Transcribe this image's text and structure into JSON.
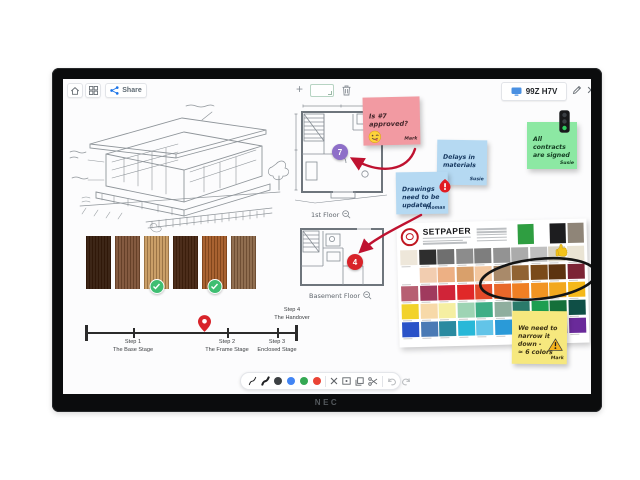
{
  "monitor": {
    "brand_label": "NEC"
  },
  "whiteboard": {
    "top_bar": {
      "share_label": "Share",
      "session_code": "99Z H7V"
    },
    "canvas": {
      "sticky_notes": {
        "approval": {
          "text": "Is #7\napproved?",
          "author": "Mark"
        },
        "delays": {
          "text": "Delays in\nmaterials",
          "author": "Susie"
        },
        "drawings": {
          "text": "Drawings\nneed to be\nupdated",
          "author": "Thomas"
        },
        "contracts": {
          "text": "All\ncontracts\nare signed",
          "author": "Susie"
        },
        "narrow": {
          "text": "We need to\nnarrow it\ndown -\n≈ 6 colors",
          "author": "Mark"
        }
      },
      "floor_plans": {
        "first": {
          "label": "1st Floor",
          "marker": "7",
          "marker_color": "#8e6fc8"
        },
        "basement": {
          "label": "Basement Floor",
          "marker": "4",
          "marker_color": "#d8232a"
        }
      },
      "wood_swatches": {
        "colors": [
          "#331a0b",
          "#7d5136",
          "#c79a60",
          "#42220f",
          "#a45a26",
          "#8a6647"
        ],
        "approved_indexes": [
          2,
          4
        ]
      },
      "palette_card": {
        "brand": "SETPAPER",
        "top_swatches": [
          "#2f9e41",
          "#1d1d1f",
          "#8f8578"
        ],
        "rows": [
          [
            "#eee7da",
            "#2e2e2e",
            "#6f6f6f",
            "#8c8c8c",
            "#7e7e7e",
            "#939393",
            "#ababab",
            "#c0c0c0",
            "#d9d3c3",
            "#eae4d4"
          ],
          [
            "#ffffff",
            "#f2cdb0",
            "#edb084",
            "#d9a06b",
            "#f3c79f",
            "#a98a6a",
            "#916333",
            "#7a4a1a",
            "#5c3310",
            "#7c2436"
          ],
          [
            "#b75f72",
            "#a03a5e",
            "#d02438",
            "#e02828",
            "#e24a2a",
            "#e8682a",
            "#ef7f24",
            "#f29422",
            "#f2a81e",
            "#f5b81a"
          ],
          [
            "#f2d22a",
            "#f7d9a8",
            "#f5efa2",
            "#9ed4b4",
            "#3fae86",
            "#8fae9e",
            "#2a7a6a",
            "#1e9e50",
            "#15703a",
            "#0f4f46"
          ],
          [
            "#2a52c8",
            "#4a7ab5",
            "#2a8aa0",
            "#28b8d8",
            "#62c4e8",
            "#2a9ad8",
            "#1a5aa8",
            "#14327a",
            "#46208a",
            "#6a2a9a"
          ]
        ]
      },
      "timeline": {
        "steps": [
          {
            "step": "Step 1",
            "name": "The Base Stage"
          },
          {
            "step": "Step 2",
            "name": "The Frame Stage"
          },
          {
            "step": "Step 3",
            "name": "Enclosed Stage"
          },
          {
            "step": "Step 4",
            "name": "The Handover"
          }
        ]
      }
    },
    "bottom_toolbar": {
      "pen_colors": [
        "#3c4043",
        "#4285f4",
        "#34a853",
        "#ea4335"
      ]
    }
  }
}
